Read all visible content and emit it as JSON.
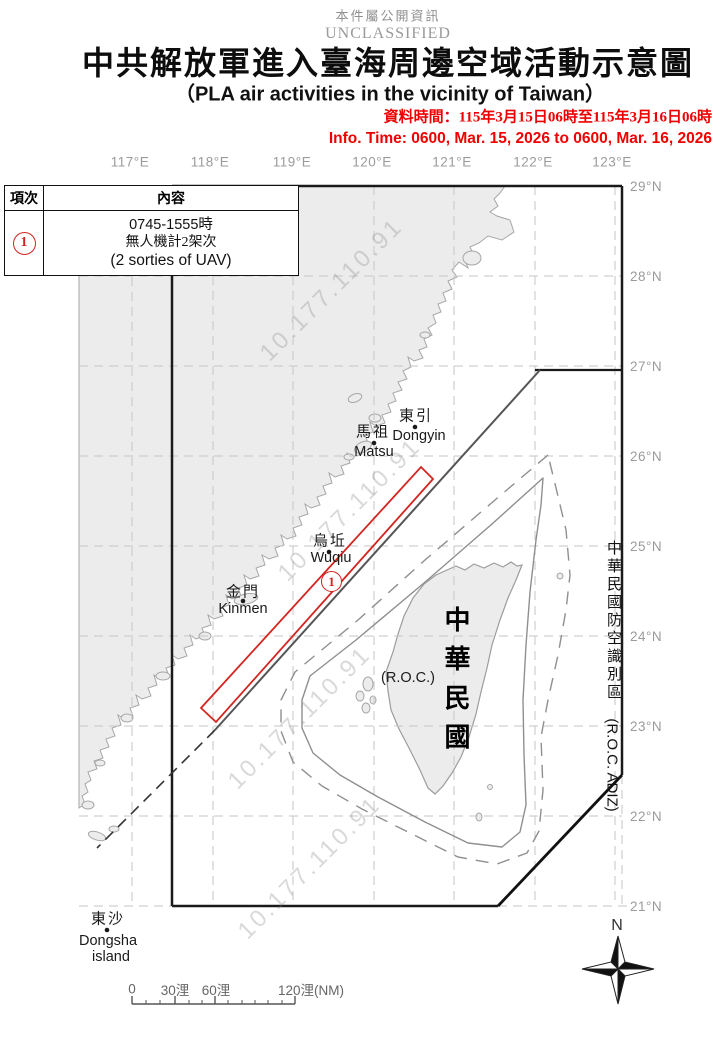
{
  "header": {
    "classification_zh": "本件屬公開資訊",
    "classification_en": "UNCLASSIFIED",
    "title_zh": "中共解放軍進入臺海周邊空域活動示意圖",
    "title_en": "（PLA air activities in the vicinity of Taiwan）",
    "info_time_zh": "資料時間：115年3月15日06時至115年3月16日06時",
    "info_time_en": "Info. Time: 0600, Mar. 15, 2026 to 0600, Mar. 16, 2026"
  },
  "table": {
    "col_no": "項次",
    "col_content": "內容",
    "row_no": "1",
    "row_lines": [
      "0745-1555時",
      "無人機計2架次",
      "(2 sorties of UAV)"
    ]
  },
  "map": {
    "lon_labels": [
      "117°E",
      "118°E",
      "119°E",
      "120°E",
      "121°E",
      "122°E",
      "123°E"
    ],
    "lat_labels": [
      "29°N",
      "28°N",
      "27°N",
      "26°N",
      "25°N",
      "24°N",
      "23°N",
      "22°N",
      "21°N"
    ],
    "places": {
      "dongyin": {
        "zh": "東引",
        "en": "Dongyin"
      },
      "matsu": {
        "zh": "馬祖",
        "en": "Matsu"
      },
      "wuqiu": {
        "zh": "烏坵",
        "en": "Wuqiu"
      },
      "kinmen": {
        "zh": "金門",
        "en": "Kinmen"
      },
      "dongsha": {
        "zh": "東沙",
        "en1": "Dongsha",
        "en2": "island"
      }
    },
    "taiwan": {
      "name_vertical": "中華民國",
      "roc": "(R.O.C.)"
    },
    "adiz": {
      "zh_vertical": "中華民國防空識別區",
      "en": "(R.O.C. ADIZ)"
    },
    "activity_marker": "1",
    "compass_north": "N",
    "scale": {
      "t0": "0",
      "t30": "30浬",
      "t60": "60浬",
      "t120": "120浬(NM)"
    }
  },
  "watermark": "10.177.110.91",
  "colors": {
    "accent_red": "#d42420",
    "info_red": "#ee0000",
    "land_fill": "#ececec",
    "coast_stroke": "#a6a6a6",
    "grid": "#c6c6c6",
    "frame": "#1a1a1a"
  }
}
